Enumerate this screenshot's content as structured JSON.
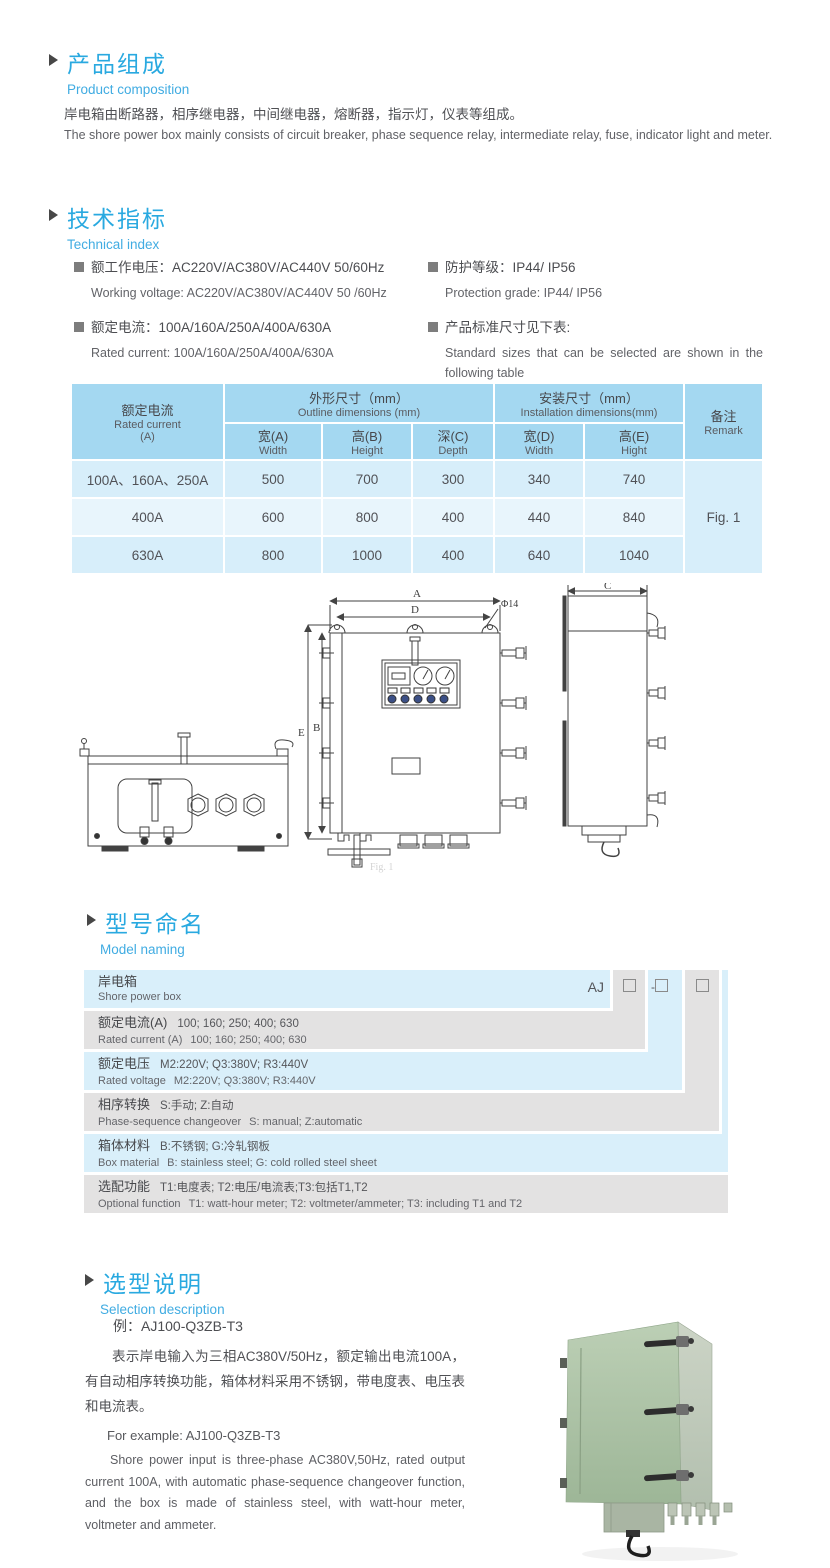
{
  "composition": {
    "title_zh": "产品组成",
    "title_en": "Product  composition",
    "body_zh": "岸电箱由断路器，相序继电器，中间继电器，熔断器，指示灯，仪表等组成。",
    "body_en": "The shore power box mainly consists of circuit breaker, phase sequence relay, intermediate relay, fuse, indicator light and meter."
  },
  "technical": {
    "title_zh": "技术指标",
    "title_en": "Technical index",
    "specs_left": [
      {
        "zh": "额工作电压：AC220V/AC380V/AC440V  50/60Hz",
        "en": "Working voltage: AC220V/AC380V/AC440V 50 /60Hz"
      },
      {
        "zh": "额定电流：100A/160A/250A/400A/630A",
        "en": "Rated current: 100A/160A/250A/400A/630A"
      }
    ],
    "specs_right": [
      {
        "zh": "防护等级：IP44/ IP56",
        "en": "Protection grade: IP44/ IP56"
      },
      {
        "zh": "产品标准尺寸见下表:",
        "en": "Standard sizes that can be selected are shown in the following table"
      }
    ]
  },
  "dimensions_table": {
    "col1_zh": "额定电流",
    "col1_en": "Rated current",
    "col1_unit": "(A)",
    "group1_zh": "外形尺寸（mm）",
    "group1_en": "Outline dimensions (mm)",
    "group2_zh": "安装尺寸（mm）",
    "group2_en": "Installation dimensions(mm)",
    "remark_zh": "备注",
    "remark_en": "Remark",
    "sub_headers": [
      {
        "zh": "宽(A)",
        "en": "Width"
      },
      {
        "zh": "高(B)",
        "en": "Height"
      },
      {
        "zh": "深(C)",
        "en": "Depth"
      },
      {
        "zh": "宽(D)",
        "en": "Width"
      },
      {
        "zh": "高(E)",
        "en": "Hight"
      }
    ],
    "rows": [
      {
        "current": "100A、160A、250A",
        "values": [
          "500",
          "700",
          "300",
          "340",
          "740"
        ]
      },
      {
        "current": "400A",
        "values": [
          "600",
          "800",
          "400",
          "440",
          "840"
        ]
      },
      {
        "current": "630A",
        "values": [
          "800",
          "1000",
          "400",
          "640",
          "1040"
        ]
      }
    ],
    "remark_value": "Fig. 1"
  },
  "drawing": {
    "labels": {
      "a": "A",
      "d": "D",
      "dia": "Φ14",
      "e": "E",
      "b": "B",
      "c": "C"
    },
    "caption": "Fig. 1"
  },
  "model_naming": {
    "title_zh": "型号命名",
    "title_en": "Model naming",
    "code_prefix": "AJ",
    "dash": "-",
    "rows": [
      {
        "zh": "岸电箱",
        "en": "Shore power box"
      },
      {
        "zh_label": "额定电流(A)",
        "zh_value": "100; 160; 250; 400; 630",
        "en_label": "Rated current (A)",
        "en_value": "100; 160; 250; 400; 630"
      },
      {
        "zh_label": "额定电压",
        "zh_value": "M2:220V;  Q3:380V;  R3:440V",
        "en_label": "Rated voltage",
        "en_value": "M2:220V;  Q3:380V;  R3:440V"
      },
      {
        "zh_label": "相序转换",
        "zh_value": "S:手动; Z:自动",
        "en_label": "Phase-sequence changeover",
        "en_value": "S: manual;  Z:automatic"
      },
      {
        "zh_label": "箱体材料",
        "zh_value": "B:不锈钢;  G:冷轧钢板",
        "en_label": "Box material",
        "en_value": "B: stainless steel; G: cold rolled steel sheet"
      },
      {
        "zh_label": "选配功能",
        "zh_value": "T1:电度表;  T2:电压/电流表;T3:包括T1,T2",
        "en_label": "Optional function",
        "en_value": "T1: watt-hour meter; T2: voltmeter/ammeter; T3: including T1 and T2"
      }
    ]
  },
  "selection": {
    "title_zh": "选型说明",
    "title_en": "Selection description",
    "example_zh": "例：AJ100-Q3ZB-T3",
    "body_zh": "表示岸电输入为三相AC380V/50Hz，额定输出电流100A，有自动相序转换功能，箱体材料采用不锈钢，带电度表、电压表和电流表。",
    "example_en": "For example: AJ100-Q3ZB-T3",
    "body_en": "Shore power input is three-phase AC380V,50Hz, rated output current 100A, with automatic phase-sequence changeover function, and the box is made of stainless steel, with watt-hour meter, voltmeter and ammeter."
  },
  "colors": {
    "accent": "#29a9e0",
    "table_header": "#a4d8f1",
    "row_light": "#d7eefa",
    "row_lighter": "#e8f5fc",
    "naming_blue": "#d9effa",
    "naming_gray": "#e3e2e2",
    "text": "#55565a",
    "photo_green": "#a9c0a2"
  }
}
